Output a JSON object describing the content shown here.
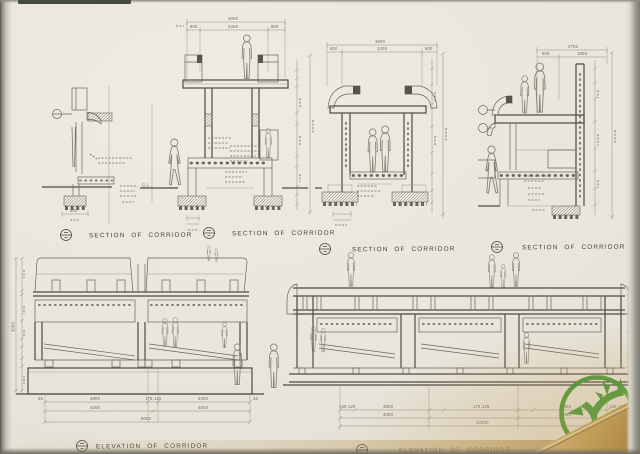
{
  "sheet": {
    "type": "scanned architectural drawing",
    "captions": {
      "s1": "SECTION OF CORRIDOR",
      "s2": "SECTION OF CORRIDOR",
      "s3": "SECTION OF CORRIDOR",
      "s4": "SECTION OF CORRIDOR",
      "e1": "ELEVATION OF CORRIDOR",
      "e2": "ELEVATION OF CORRIDOR"
    },
    "annotations": {
      "ground_level": "G.L."
    }
  },
  "dims": {
    "s2_total": "4000",
    "s2_parts": [
      "800",
      "2400",
      "800"
    ],
    "s3_total": "3600",
    "s3_parts": [
      "600",
      "2400",
      "600"
    ],
    "s4_total": "2700",
    "s4_parts": [
      "900",
      "1800"
    ],
    "s1_footing": "600",
    "e1_height": "3000",
    "e1_row1": [
      "45",
      "3800",
      "175,125",
      "4000",
      "45"
    ],
    "e1_row2": [
      "4000",
      "4000"
    ],
    "e1_total": "8000",
    "e2_row1": [
      "150,125",
      "3800",
      "175,125",
      "3800",
      "150,125"
    ],
    "e2_row2": [
      "4000",
      "4000"
    ],
    "e2_total": "12000"
  },
  "logo": {
    "name": "stag-tree-emblem",
    "color": "#3f9331"
  },
  "colors": {
    "paper": "#e9e6de",
    "pencil": "#6b6557",
    "stain": "#c8a25c",
    "scan_edge": "#7e7c73"
  }
}
